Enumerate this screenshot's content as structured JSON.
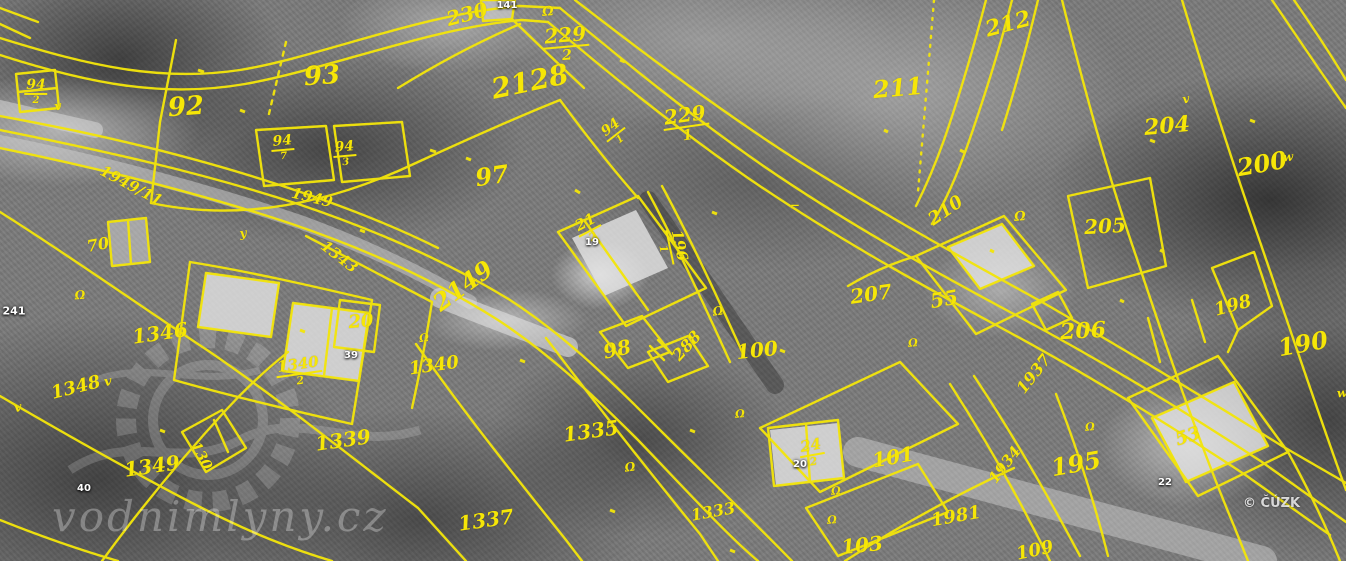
{
  "map": {
    "kind": "cadastral-map-over-aerial-photo",
    "colors": {
      "cadastral_yellow": "#f6e607",
      "house_label_white": "#ffffff"
    },
    "attribution": "© ČÚZK",
    "watermark_text": "vodnimlyny.cz",
    "labels": [
      {
        "text": "2128",
        "x": 530,
        "y": 82,
        "rot": -12,
        "size": 28,
        "kind": "parcel"
      },
      {
        "text": "92",
        "x": 186,
        "y": 107,
        "rot": -4,
        "size": 26,
        "kind": "parcel"
      },
      {
        "text": "93",
        "x": 322,
        "y": 76,
        "rot": -4,
        "size": 26,
        "kind": "parcel"
      },
      {
        "text": "97",
        "x": 492,
        "y": 176,
        "rot": -8,
        "size": 24,
        "kind": "parcel"
      },
      {
        "text": "230",
        "x": 467,
        "y": 14,
        "rot": -15,
        "size": 20,
        "kind": "parcel"
      },
      {
        "text": "229",
        "den": "2",
        "x": 566,
        "y": 44,
        "rot": -5,
        "size": 20,
        "kind": "parcel"
      },
      {
        "text": "229",
        "den": "1",
        "x": 686,
        "y": 124,
        "rot": -8,
        "size": 20,
        "kind": "parcel"
      },
      {
        "text": "94",
        "den": "2",
        "x": 36,
        "y": 92,
        "rot": 0,
        "size": 14,
        "kind": "parcel"
      },
      {
        "text": "94",
        "den": "7",
        "x": 283,
        "y": 148,
        "rot": -5,
        "size": 14,
        "kind": "parcel"
      },
      {
        "text": "94",
        "den": "3",
        "x": 345,
        "y": 154,
        "rot": -5,
        "size": 14,
        "kind": "parcel"
      },
      {
        "text": "94",
        "den": "1",
        "x": 615,
        "y": 133,
        "rot": -38,
        "size": 14,
        "kind": "parcel"
      },
      {
        "text": "211",
        "x": 898,
        "y": 88,
        "rot": -5,
        "size": 24,
        "kind": "parcel"
      },
      {
        "text": "212",
        "x": 1008,
        "y": 24,
        "rot": -15,
        "size": 22,
        "kind": "parcel"
      },
      {
        "text": "204",
        "x": 1167,
        "y": 126,
        "rot": -5,
        "size": 22,
        "kind": "parcel"
      },
      {
        "text": "200",
        "x": 1262,
        "y": 164,
        "rot": -10,
        "size": 24,
        "kind": "parcel"
      },
      {
        "text": "205",
        "x": 1105,
        "y": 226,
        "rot": -3,
        "size": 20,
        "kind": "parcel"
      },
      {
        "text": "210",
        "x": 946,
        "y": 211,
        "rot": -35,
        "size": 18,
        "kind": "parcel"
      },
      {
        "text": "207",
        "x": 871,
        "y": 294,
        "rot": -8,
        "size": 20,
        "kind": "parcel"
      },
      {
        "text": "55",
        "x": 944,
        "y": 299,
        "rot": -10,
        "size": 20,
        "kind": "parcel"
      },
      {
        "text": "206",
        "x": 1083,
        "y": 331,
        "rot": -3,
        "size": 22,
        "kind": "parcel"
      },
      {
        "text": "198",
        "x": 1233,
        "y": 306,
        "rot": -15,
        "size": 18,
        "kind": "parcel"
      },
      {
        "text": "190",
        "x": 1303,
        "y": 344,
        "rot": -10,
        "size": 24,
        "kind": "parcel"
      },
      {
        "text": "1937",
        "x": 1034,
        "y": 374,
        "rot": -52,
        "size": 16,
        "kind": "parcel"
      },
      {
        "text": "196",
        "den": "1",
        "x": 672,
        "y": 247,
        "rot": 78,
        "size": 15,
        "kind": "parcel"
      },
      {
        "text": "21",
        "den": "2",
        "x": 589,
        "y": 229,
        "rot": -28,
        "size": 15,
        "kind": "parcel"
      },
      {
        "text": "98",
        "x": 617,
        "y": 349,
        "rot": -12,
        "size": 20,
        "kind": "parcel"
      },
      {
        "text": "288",
        "x": 687,
        "y": 346,
        "rot": -48,
        "size": 16,
        "kind": "parcel"
      },
      {
        "text": "100",
        "x": 757,
        "y": 350,
        "rot": -6,
        "size": 20,
        "kind": "parcel"
      },
      {
        "text": "2149",
        "x": 463,
        "y": 286,
        "rot": -36,
        "size": 24,
        "kind": "parcel"
      },
      {
        "text": "1949/11",
        "x": 131,
        "y": 186,
        "rot": 28,
        "size": 15,
        "kind": "parcel"
      },
      {
        "text": "1949",
        "x": 312,
        "y": 198,
        "rot": 14,
        "size": 15,
        "kind": "parcel"
      },
      {
        "text": "1343",
        "x": 339,
        "y": 257,
        "rot": 38,
        "size": 15,
        "kind": "parcel"
      },
      {
        "text": "70",
        "x": 98,
        "y": 245,
        "rot": -10,
        "size": 16,
        "kind": "parcel"
      },
      {
        "text": "1346",
        "x": 160,
        "y": 333,
        "rot": -8,
        "size": 20,
        "kind": "parcel"
      },
      {
        "text": "1348",
        "x": 76,
        "y": 388,
        "rot": -14,
        "size": 18,
        "kind": "parcel"
      },
      {
        "text": "1349",
        "x": 152,
        "y": 466,
        "rot": -8,
        "size": 20,
        "kind": "parcel"
      },
      {
        "text": "130",
        "x": 201,
        "y": 456,
        "rot": 62,
        "size": 14,
        "kind": "parcel"
      },
      {
        "text": "1340",
        "den": "2",
        "x": 299,
        "y": 372,
        "rot": -8,
        "size": 15,
        "kind": "parcel"
      },
      {
        "text": "1340",
        "x": 434,
        "y": 366,
        "rot": -8,
        "size": 18,
        "kind": "parcel"
      },
      {
        "text": "20",
        "x": 361,
        "y": 322,
        "rot": -5,
        "size": 18,
        "kind": "parcel"
      },
      {
        "text": "1339",
        "x": 343,
        "y": 440,
        "rot": -8,
        "size": 20,
        "kind": "parcel"
      },
      {
        "text": "1335",
        "x": 591,
        "y": 431,
        "rot": -8,
        "size": 20,
        "kind": "parcel"
      },
      {
        "text": "1337",
        "x": 486,
        "y": 520,
        "rot": -8,
        "size": 20,
        "kind": "parcel"
      },
      {
        "text": "1333",
        "x": 713,
        "y": 512,
        "rot": -10,
        "size": 16,
        "kind": "parcel"
      },
      {
        "text": "24",
        "den": "2",
        "x": 812,
        "y": 453,
        "rot": -10,
        "size": 15,
        "kind": "parcel"
      },
      {
        "text": "101",
        "x": 893,
        "y": 457,
        "rot": -10,
        "size": 20,
        "kind": "parcel"
      },
      {
        "text": "1981",
        "x": 956,
        "y": 517,
        "rot": -10,
        "size": 18,
        "kind": "parcel"
      },
      {
        "text": "103",
        "x": 862,
        "y": 545,
        "rot": -6,
        "size": 20,
        "kind": "parcel"
      },
      {
        "text": "109",
        "x": 1035,
        "y": 551,
        "rot": -12,
        "size": 18,
        "kind": "parcel"
      },
      {
        "text": "1934",
        "x": 1005,
        "y": 465,
        "rot": -52,
        "size": 15,
        "kind": "parcel"
      },
      {
        "text": "195",
        "x": 1076,
        "y": 464,
        "rot": -10,
        "size": 24,
        "kind": "parcel"
      },
      {
        "text": "53",
        "x": 1188,
        "y": 437,
        "rot": -18,
        "size": 18,
        "kind": "parcel"
      },
      {
        "text": "141",
        "x": 507,
        "y": 6,
        "rot": 0,
        "size": 10,
        "kind": "house"
      },
      {
        "text": "241",
        "x": 14,
        "y": 311,
        "rot": 0,
        "size": 11,
        "kind": "house"
      },
      {
        "text": "39",
        "x": 351,
        "y": 356,
        "rot": 0,
        "size": 10,
        "kind": "house"
      },
      {
        "text": "40",
        "x": 84,
        "y": 489,
        "rot": 0,
        "size": 10,
        "kind": "house"
      },
      {
        "text": "19",
        "x": 592,
        "y": 243,
        "rot": 0,
        "size": 10,
        "kind": "house"
      },
      {
        "text": "20",
        "x": 800,
        "y": 465,
        "rot": 0,
        "size": 10,
        "kind": "house"
      },
      {
        "text": "22",
        "x": 1165,
        "y": 483,
        "rot": 0,
        "size": 10,
        "kind": "house"
      },
      {
        "text": "Ω",
        "x": 548,
        "y": 12,
        "rot": -5,
        "size": 13,
        "kind": "symbol"
      },
      {
        "text": "Ω",
        "x": 1020,
        "y": 217,
        "rot": -5,
        "size": 13,
        "kind": "symbol"
      },
      {
        "text": "Ω",
        "x": 718,
        "y": 311,
        "rot": -8,
        "size": 12,
        "kind": "symbol"
      },
      {
        "text": "Ω",
        "x": 630,
        "y": 467,
        "rot": -8,
        "size": 12,
        "kind": "symbol"
      },
      {
        "text": "Ω",
        "x": 836,
        "y": 491,
        "rot": -5,
        "size": 11,
        "kind": "symbol"
      },
      {
        "text": "Ω",
        "x": 913,
        "y": 343,
        "rot": -5,
        "size": 11,
        "kind": "symbol"
      },
      {
        "text": "Ω",
        "x": 424,
        "y": 338,
        "rot": -8,
        "size": 11,
        "kind": "symbol"
      },
      {
        "text": "Ω",
        "x": 80,
        "y": 295,
        "rot": -5,
        "size": 12,
        "kind": "symbol"
      },
      {
        "text": "Ω",
        "x": 1090,
        "y": 427,
        "rot": -5,
        "size": 11,
        "kind": "symbol"
      },
      {
        "text": "Ω",
        "x": 740,
        "y": 414,
        "rot": -5,
        "size": 11,
        "kind": "symbol"
      },
      {
        "text": "Ω",
        "x": 832,
        "y": 520,
        "rot": -5,
        "size": 11,
        "kind": "symbol"
      },
      {
        "text": "v",
        "x": 18,
        "y": 408,
        "rot": -10,
        "size": 13,
        "kind": "symbol"
      },
      {
        "text": "v",
        "x": 108,
        "y": 382,
        "rot": -10,
        "size": 13,
        "kind": "symbol"
      },
      {
        "text": "v",
        "x": 58,
        "y": 106,
        "rot": -10,
        "size": 12,
        "kind": "symbol"
      },
      {
        "text": "v",
        "x": 1186,
        "y": 99,
        "rot": -10,
        "size": 12,
        "kind": "symbol"
      },
      {
        "text": "w",
        "x": 1342,
        "y": 393,
        "rot": -5,
        "size": 12,
        "kind": "symbol"
      },
      {
        "text": "w",
        "x": 1288,
        "y": 157,
        "rot": -5,
        "size": 12,
        "kind": "symbol"
      },
      {
        "text": "y",
        "x": 243,
        "y": 233,
        "rot": -8,
        "size": 12,
        "kind": "symbol"
      },
      {
        "text": "⌐",
        "x": 795,
        "y": 206,
        "rot": 0,
        "size": 12,
        "kind": "symbol"
      }
    ]
  }
}
